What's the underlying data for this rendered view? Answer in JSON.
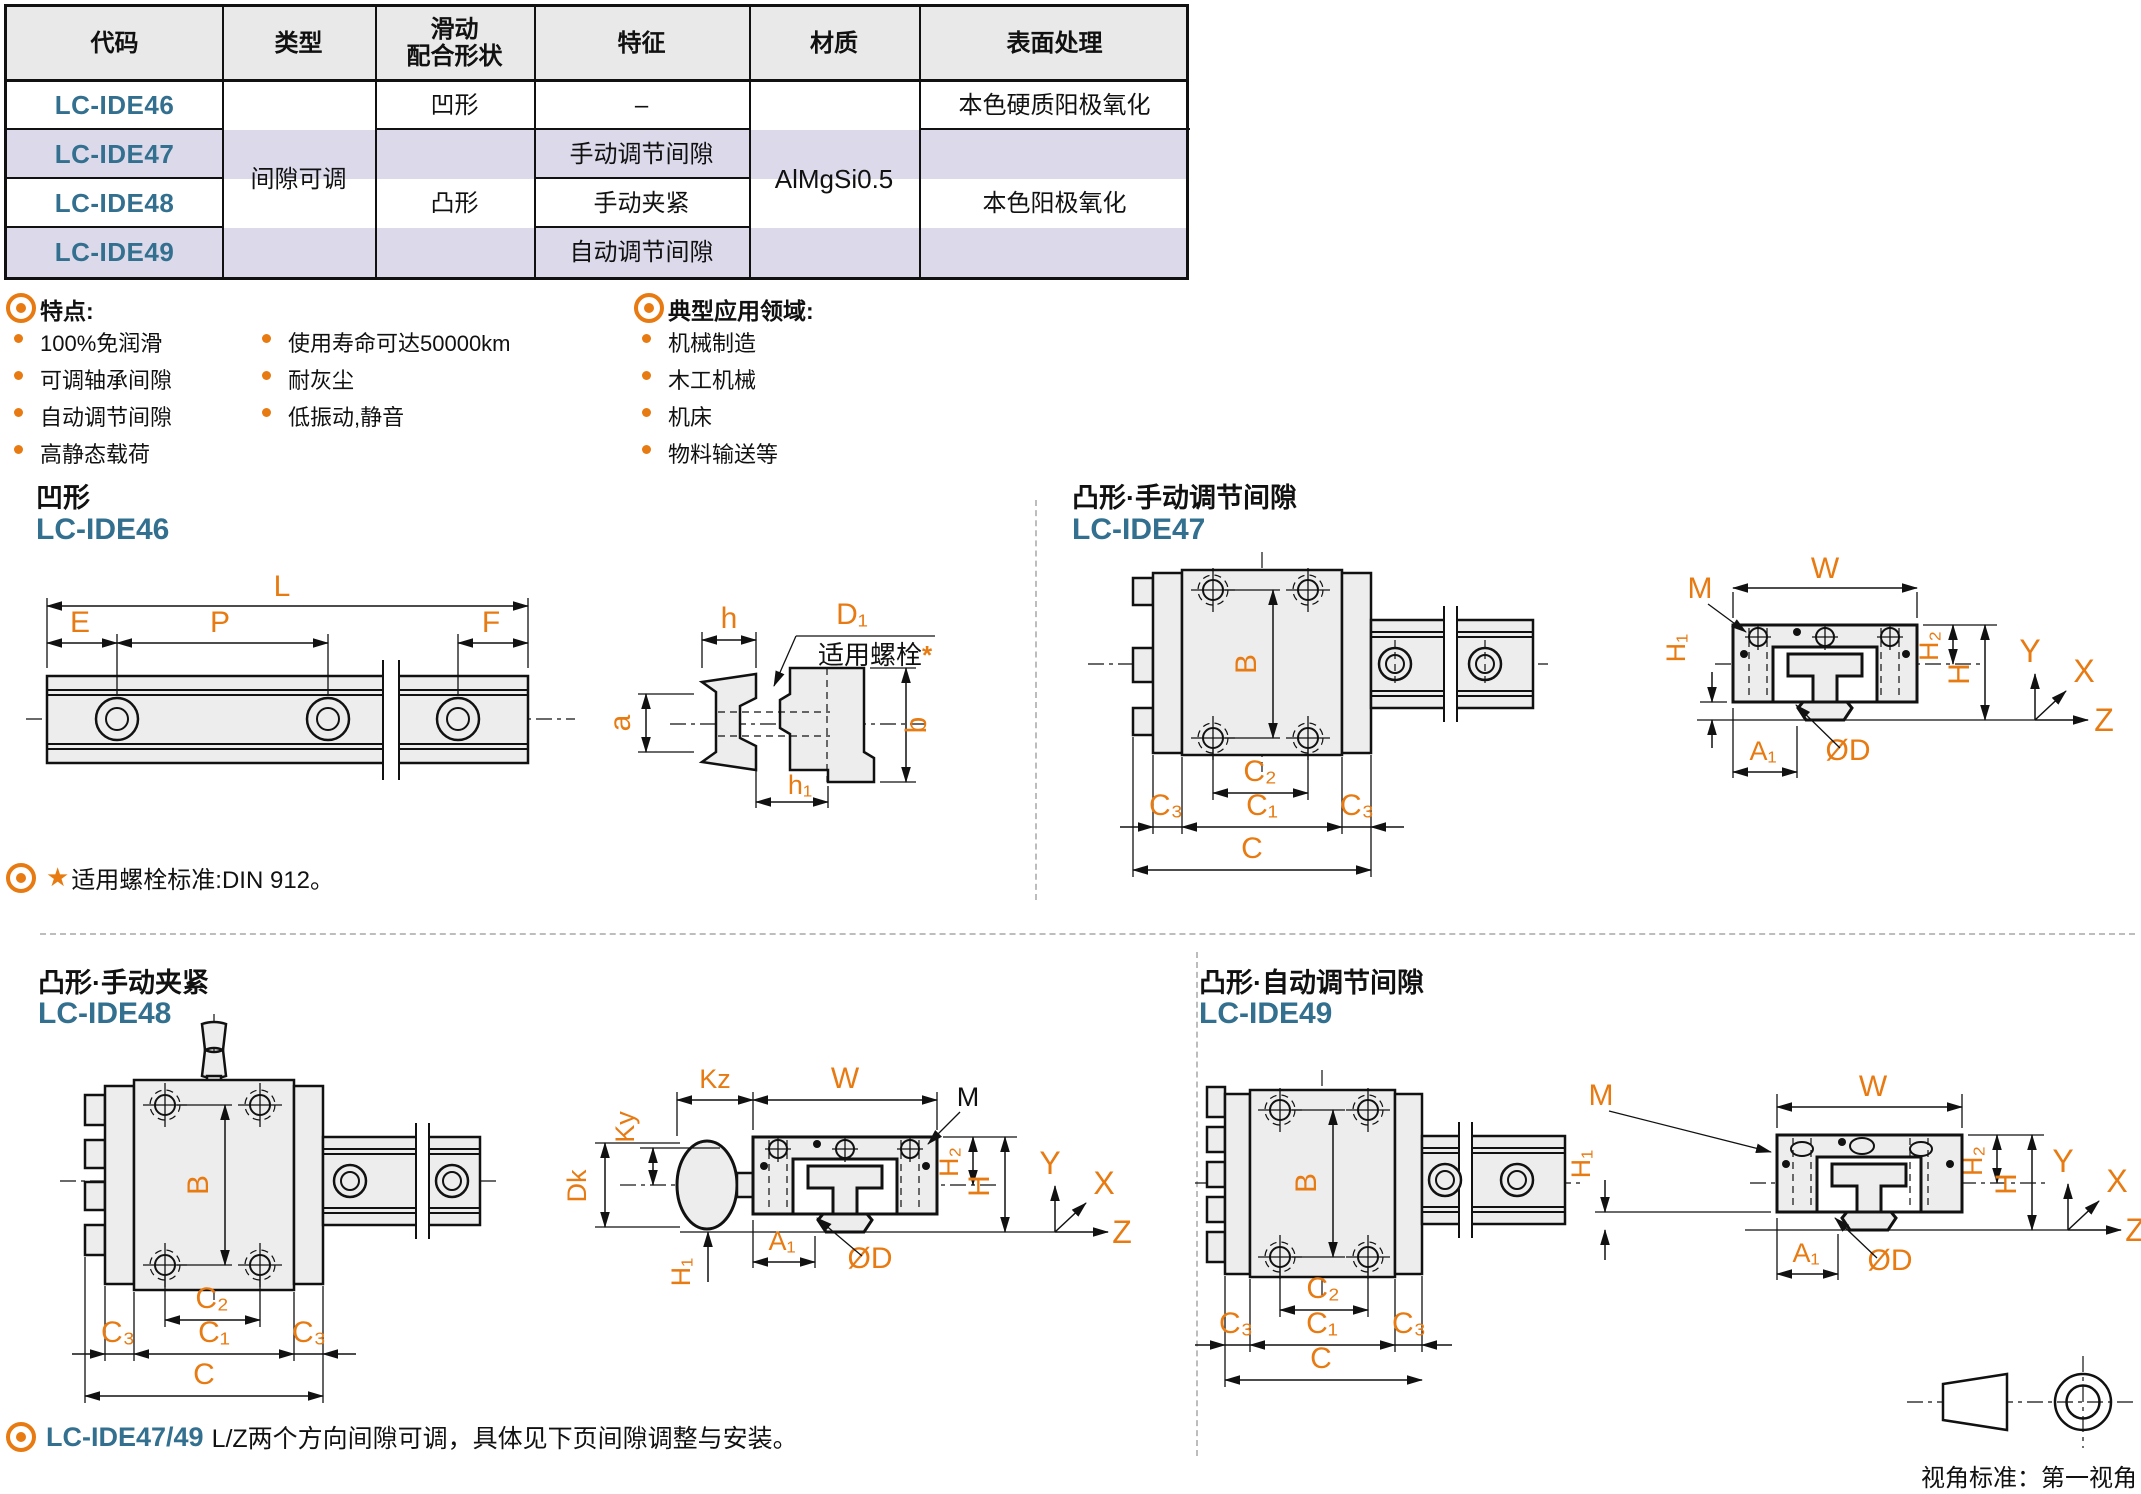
{
  "colors": {
    "accent_orange": "#E87A12",
    "code_blue": "#33708F",
    "row_alt_lavender": "#DBD9EA",
    "header_gray": "#E9E9E9",
    "drawing_fill": "#EDEDED",
    "line_black": "#111111",
    "divider_gray": "#BDBDBD"
  },
  "table": {
    "headers": [
      "代码",
      "类型",
      "滑动",
      "配合形状",
      "特征",
      "材质",
      "表面处理"
    ],
    "codes": [
      "LC-IDE46",
      "LC-IDE47",
      "LC-IDE48",
      "LC-IDE49"
    ],
    "type_merged": "间隙可调",
    "shape_concave": "凹形",
    "shape_convex": "凸形",
    "feature_cells": [
      "–",
      "手动调节间隙",
      "手动夹紧",
      "自动调节间隙"
    ],
    "material_merged": "AlMgSi0.5",
    "surface_row1": "本色硬质阳极氧化",
    "surface_merged": "本色阳极氧化"
  },
  "features": {
    "title": "特点:",
    "col1": [
      "100%免润滑",
      "可调轴承间隙",
      "自动调节间隙",
      "高静态载荷"
    ],
    "col2": [
      "使用寿命可达50000km",
      "耐灰尘",
      "低振动,静音"
    ]
  },
  "applications": {
    "title": "典型应用领域:",
    "items": [
      "机械制造",
      "木工机械",
      "机床",
      "物料输送等"
    ]
  },
  "sections": {
    "ide46": {
      "title": "凹形",
      "code": "LC-IDE46",
      "dims": {
        "L": "L",
        "E": "E",
        "P": "P",
        "F": "F",
        "h": "h",
        "D1": "D₁",
        "a": "a",
        "b": "b",
        "h1": "h₁"
      },
      "callout_text": "适用螺栓",
      "callout_star": "*"
    },
    "ide47": {
      "title": "凸形·手动调节间隙",
      "code": "LC-IDE47",
      "dims": {
        "B": "B",
        "C2": "C₂",
        "C1": "C₁",
        "C3": "C₃",
        "C": "C",
        "M": "M",
        "W": "W",
        "H1": "H₁",
        "H2": "H₂",
        "H": "H",
        "A1": "A₁",
        "OD": "ØD"
      },
      "axes": {
        "x": "X",
        "y": "Y",
        "z": "Z"
      }
    },
    "ide48": {
      "title": "凸形·手动夹紧",
      "code": "LC-IDE48",
      "dims": {
        "B": "B",
        "C2": "C₂",
        "C1": "C₁",
        "C3": "C₃",
        "C": "C",
        "M": "M",
        "W": "W",
        "H1": "H₁",
        "H2": "H₂",
        "H": "H",
        "A1": "A₁",
        "OD": "ØD",
        "Kz": "Kz",
        "Ky": "Ky",
        "Dk": "Dk"
      },
      "axes": {
        "x": "X",
        "y": "Y",
        "z": "Z"
      }
    },
    "ide49": {
      "title": "凸形·自动调节间隙",
      "code": "LC-IDE49",
      "dims": {
        "B": "B",
        "C2": "C₂",
        "C1": "C₁",
        "C3": "C₃",
        "C": "C",
        "M": "M",
        "W": "W",
        "H1": "H₁",
        "H2": "H₂",
        "H": "H",
        "A1": "A₁",
        "OD": "ØD"
      },
      "axes": {
        "x": "X",
        "y": "Y",
        "z": "Z"
      }
    }
  },
  "notes": {
    "bolt": {
      "star": "★",
      "text": "适用螺栓标准:DIN 912。"
    },
    "adjust": {
      "code": "LC-IDE47/49",
      "text": "L/Z两个方向间隙可调，具体见下页间隙调整与安装。"
    }
  },
  "view_standard": "视角标准：第一视角"
}
